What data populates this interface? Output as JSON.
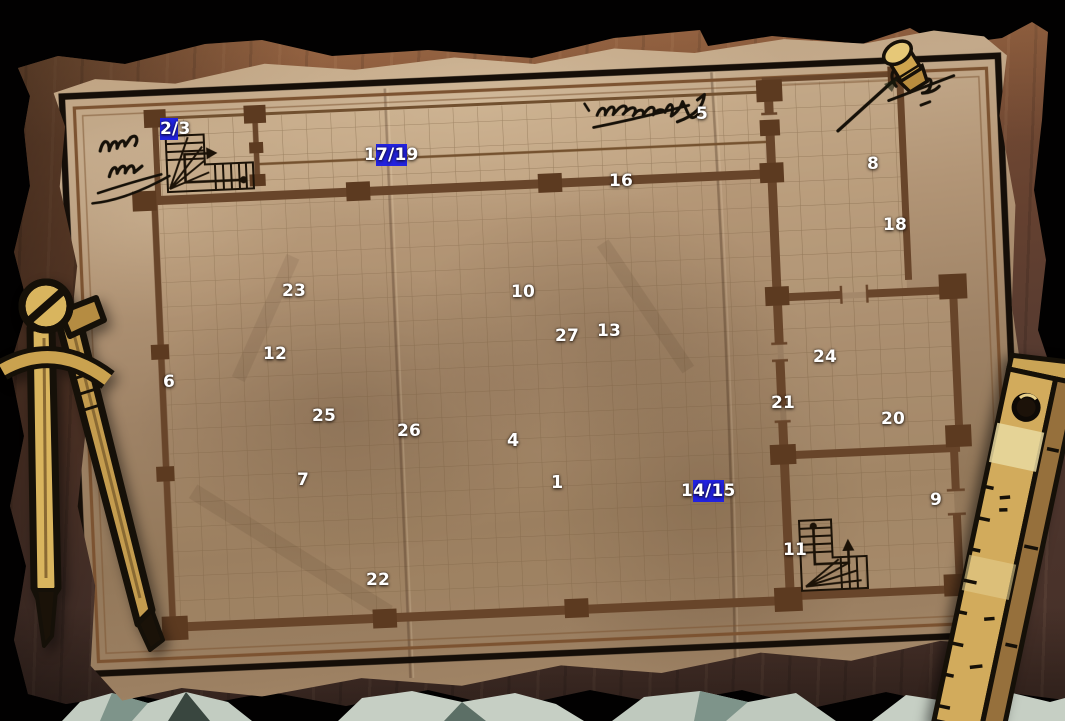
{
  "scene": {
    "description": "Hand-drawn building floor plan on crumpled parchment, pinned to a dark wooden desk",
    "floor_plan_features": [
      "grid-paper",
      "room-walls-with-pillars",
      "two-staircases",
      "door-openings",
      "ink-scribble-annotations"
    ]
  },
  "map": {
    "markers": [
      {
        "id": "2-3",
        "segments": [
          {
            "text": "2/",
            "highlight": true
          },
          {
            "text": "3",
            "highlight": false
          }
        ],
        "x": 160,
        "y": 119,
        "bold": false
      },
      {
        "id": "17-19",
        "segments": [
          {
            "text": "1",
            "highlight": false
          },
          {
            "text": "7/1",
            "highlight": true
          },
          {
            "text": "9",
            "highlight": false
          }
        ],
        "x": 364,
        "y": 145,
        "bold": false
      },
      {
        "id": "5",
        "segments": [
          {
            "text": "5",
            "highlight": false
          }
        ],
        "x": 696,
        "y": 104,
        "bold": false
      },
      {
        "id": "16",
        "segments": [
          {
            "text": "16",
            "highlight": false
          }
        ],
        "x": 609,
        "y": 171,
        "bold": false
      },
      {
        "id": "8",
        "segments": [
          {
            "text": "8",
            "highlight": false
          }
        ],
        "x": 867,
        "y": 154,
        "bold": false
      },
      {
        "id": "18",
        "segments": [
          {
            "text": "18",
            "highlight": false
          }
        ],
        "x": 883,
        "y": 215,
        "bold": false
      },
      {
        "id": "23",
        "segments": [
          {
            "text": "23",
            "highlight": false
          }
        ],
        "x": 282,
        "y": 281,
        "bold": false
      },
      {
        "id": "10",
        "segments": [
          {
            "text": "10",
            "highlight": false
          }
        ],
        "x": 511,
        "y": 282,
        "bold": false
      },
      {
        "id": "27",
        "segments": [
          {
            "text": "27",
            "highlight": false
          }
        ],
        "x": 555,
        "y": 326,
        "bold": false
      },
      {
        "id": "13",
        "segments": [
          {
            "text": "13",
            "highlight": false
          }
        ],
        "x": 597,
        "y": 321,
        "bold": false
      },
      {
        "id": "12",
        "segments": [
          {
            "text": "12",
            "highlight": false
          }
        ],
        "x": 263,
        "y": 344,
        "bold": false
      },
      {
        "id": "24",
        "segments": [
          {
            "text": "24",
            "highlight": false
          }
        ],
        "x": 813,
        "y": 347,
        "bold": false
      },
      {
        "id": "6",
        "segments": [
          {
            "text": "6",
            "highlight": false
          }
        ],
        "x": 163,
        "y": 372,
        "bold": false
      },
      {
        "id": "21",
        "segments": [
          {
            "text": "21",
            "highlight": false
          }
        ],
        "x": 771,
        "y": 393,
        "bold": false
      },
      {
        "id": "25",
        "segments": [
          {
            "text": "25",
            "highlight": false
          }
        ],
        "x": 312,
        "y": 406,
        "bold": false
      },
      {
        "id": "20",
        "segments": [
          {
            "text": "20",
            "highlight": false
          }
        ],
        "x": 881,
        "y": 409,
        "bold": false
      },
      {
        "id": "26",
        "segments": [
          {
            "text": "26",
            "highlight": false
          }
        ],
        "x": 397,
        "y": 421,
        "bold": false
      },
      {
        "id": "4",
        "segments": [
          {
            "text": "4",
            "highlight": false
          }
        ],
        "x": 507,
        "y": 431,
        "bold": true
      },
      {
        "id": "1",
        "segments": [
          {
            "text": "1",
            "highlight": false
          }
        ],
        "x": 551,
        "y": 473,
        "bold": true
      },
      {
        "id": "14-15",
        "segments": [
          {
            "text": "1",
            "highlight": false
          },
          {
            "text": "4/1",
            "highlight": true
          },
          {
            "text": "5",
            "highlight": false
          }
        ],
        "x": 681,
        "y": 481,
        "bold": false
      },
      {
        "id": "7",
        "segments": [
          {
            "text": "7",
            "highlight": false
          }
        ],
        "x": 297,
        "y": 470,
        "bold": false
      },
      {
        "id": "9",
        "segments": [
          {
            "text": "9",
            "highlight": false
          }
        ],
        "x": 930,
        "y": 490,
        "bold": false
      },
      {
        "id": "11",
        "segments": [
          {
            "text": "11",
            "highlight": false
          }
        ],
        "x": 783,
        "y": 540,
        "bold": false
      },
      {
        "id": "22",
        "segments": [
          {
            "text": "22",
            "highlight": false
          }
        ],
        "x": 366,
        "y": 570,
        "bold": false
      }
    ]
  },
  "decorations": [
    "drafting-compass-icon",
    "wooden-ruler-icon",
    "push-pin-icon",
    "ink-scribble",
    "staircase-glyph"
  ],
  "colors": {
    "selection_highlight": "#2222df",
    "marker_text": "#ffffff",
    "parchment": "#b29576",
    "map_wall": "#68452a",
    "frame_black": "#150e08",
    "frame_brown": "#7c5331",
    "desk_wood": "#654130",
    "ink": "#191007",
    "brass": "#d9b55e",
    "reveal_paper": "#c2ccc1"
  }
}
